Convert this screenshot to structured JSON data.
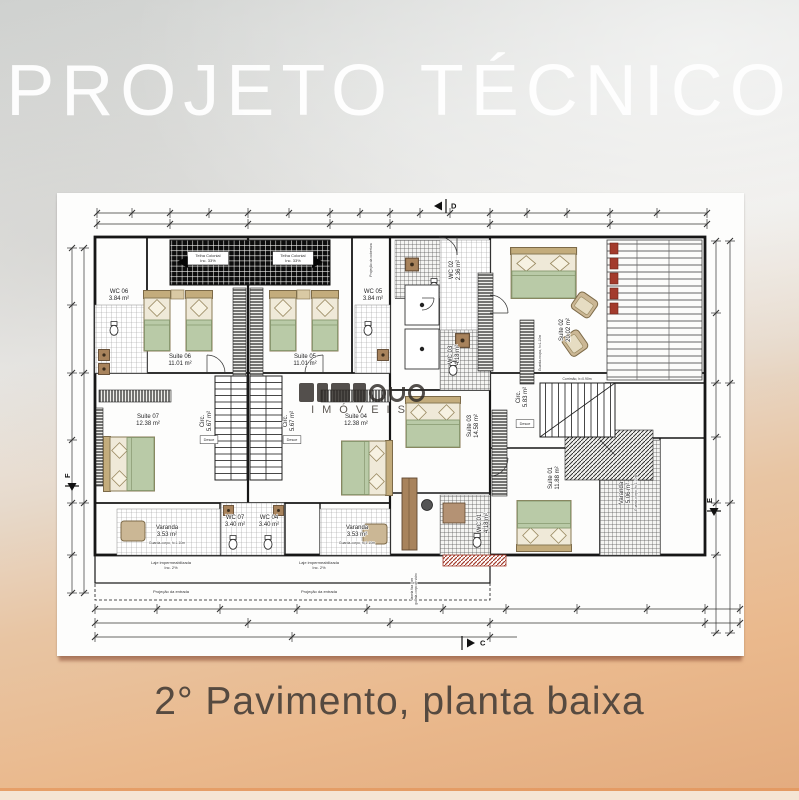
{
  "page": {
    "title": "PROJETO TÉCNICO",
    "caption": "2° Pavimento, planta baixa"
  },
  "watermark": {
    "text": "IMÓVEIS"
  },
  "colors": {
    "background_top": "#d1d2d0",
    "background_bottom": "#e5ad80",
    "paper": "#fdfdfc",
    "line": "#1a1a1a",
    "bed_tan": "#d5c29a",
    "blanket_green": "#b9caa7",
    "wood_brown": "#a8835c",
    "accent_red": "#a33b2c",
    "title_color": "#ffffff",
    "caption_color": "#564a40"
  },
  "floorplan": {
    "rooms": [
      {
        "name": "WC 06",
        "area": "3.84 m²",
        "x": 62,
        "y": 100,
        "rot": 0
      },
      {
        "name": "Suite 06",
        "area": "11.01 m²",
        "x": 123,
        "y": 165,
        "rot": 0
      },
      {
        "name": "Suite 05",
        "area": "11.01 m²",
        "x": 248,
        "y": 165,
        "rot": 0
      },
      {
        "name": "WC 05",
        "area": "3.84 m²",
        "x": 316,
        "y": 100,
        "rot": 0
      },
      {
        "name": "WC 02",
        "area": "2.36 m²",
        "x": 396,
        "y": 77,
        "rot": -90
      },
      {
        "name": "WC 03",
        "area": "4.18 m²",
        "x": 395,
        "y": 162,
        "rot": -90
      },
      {
        "name": "Suite 02",
        "area": "20.02 m²",
        "x": 506,
        "y": 137,
        "rot": -90
      },
      {
        "name": "Suite 07",
        "area": "12.38 m²",
        "x": 91,
        "y": 225,
        "rot": 0
      },
      {
        "name": "Circ.",
        "area": "5.67 m²",
        "x": 147,
        "y": 228,
        "rot": -90
      },
      {
        "name": "Circ.",
        "area": "5.67 m²",
        "x": 230,
        "y": 228,
        "rot": -90
      },
      {
        "name": "Suite 04",
        "area": "12.38 m²",
        "x": 299,
        "y": 225,
        "rot": 0
      },
      {
        "name": "Suite 03",
        "area": "14.58 m²",
        "x": 414,
        "y": 233,
        "rot": -90
      },
      {
        "name": "Circ.",
        "area": "5.83 m²",
        "x": 463,
        "y": 204,
        "rot": -90
      },
      {
        "name": "Suite 01",
        "area": "11.88 m²",
        "x": 495,
        "y": 285,
        "rot": -90
      },
      {
        "name": "WC 01",
        "area": "4.18 m²",
        "x": 424,
        "y": 330,
        "rot": -90
      },
      {
        "name": "WC 07",
        "area": "3.40 m²",
        "x": 178,
        "y": 326,
        "rot": 0
      },
      {
        "name": "WC 04",
        "area": "3.40 m²",
        "x": 212,
        "y": 326,
        "rot": 0
      },
      {
        "name": "Varanda",
        "area": "3.53 m²",
        "x": 110,
        "y": 336,
        "rot": 0
      },
      {
        "name": "Varanda",
        "area": "3.53 m²",
        "x": 300,
        "y": 336,
        "rot": 0
      },
      {
        "name": "Varanda",
        "area": "5.06 m²",
        "x": 566,
        "y": 300,
        "rot": -90
      }
    ],
    "annotations": [
      {
        "lines": [
          "Telha Colonial",
          "Inc. 33%"
        ],
        "x": 151,
        "y": 64,
        "size": 4,
        "rot": 0,
        "box": true
      },
      {
        "lines": [
          "Telha Colonial",
          "Inc. 33%"
        ],
        "x": 236,
        "y": 64,
        "size": 4,
        "rot": 0,
        "box": true
      },
      {
        "lines": [
          "Desce"
        ],
        "x": 152,
        "y": 248,
        "size": 3.8,
        "rot": 0,
        "box": true
      },
      {
        "lines": [
          "Desce"
        ],
        "x": 235,
        "y": 248,
        "size": 3.8,
        "rot": 0,
        "box": true
      },
      {
        "lines": [
          "Desce"
        ],
        "x": 468,
        "y": 232,
        "size": 3.8,
        "rot": 0,
        "box": true
      },
      {
        "lines": [
          "Corrimão, h=0.90m"
        ],
        "x": 520,
        "y": 187,
        "size": 3.4,
        "rot": 0,
        "box": false
      },
      {
        "lines": [
          "Guarda-roupa, h=1.10m"
        ],
        "x": 484,
        "y": 160,
        "size": 3.4,
        "rot": -90,
        "box": false
      },
      {
        "lines": [
          "Guarda-corpo, h=1.10m"
        ],
        "x": 110,
        "y": 351,
        "size": 3.4,
        "rot": 0,
        "box": false
      },
      {
        "lines": [
          "Guarda-corpo, h=1.10m"
        ],
        "x": 300,
        "y": 351,
        "size": 3.4,
        "rot": 0,
        "box": false
      },
      {
        "lines": [
          "Guarda-corpo, h=1.10m"
        ],
        "x": 580,
        "y": 300,
        "size": 3.4,
        "rot": -90,
        "box": false
      },
      {
        "lines": [
          "Laje impermeabilizada",
          "Inc. 2%"
        ],
        "x": 114,
        "y": 371,
        "size": 4,
        "rot": 0,
        "box": false
      },
      {
        "lines": [
          "Laje impermeabilizada",
          "Inc. 2%"
        ],
        "x": 262,
        "y": 371,
        "size": 4,
        "rot": 0,
        "box": false
      },
      {
        "lines": [
          "Projeção da entrada"
        ],
        "x": 114,
        "y": 400,
        "size": 4,
        "rot": 0,
        "box": false
      },
      {
        "lines": [
          "Projeção da entrada"
        ],
        "x": 262,
        "y": 400,
        "size": 4,
        "rot": 0,
        "box": false
      },
      {
        "lines": [
          "Projeção da cobertura"
        ],
        "x": 315,
        "y": 67,
        "size": 3.4,
        "rot": -90,
        "box": false
      },
      {
        "lines": [
          "Janela fixa com",
          "guarda-corpo de vidro"
        ],
        "x": 356,
        "y": 396,
        "size": 3.2,
        "rot": -90,
        "box": false
      }
    ],
    "section_markers": [
      {
        "label": "D",
        "x": 384,
        "y": 13,
        "dir": "left",
        "rot": 0
      },
      {
        "label": "C",
        "x": 410,
        "y": 450,
        "dir": "right",
        "rot": 0
      },
      {
        "label": "E",
        "x": 657,
        "y": 316,
        "dir": "down",
        "rot": -90
      },
      {
        "label": "F",
        "x": 15,
        "y": 291,
        "dir": "down",
        "rot": -90
      }
    ]
  }
}
